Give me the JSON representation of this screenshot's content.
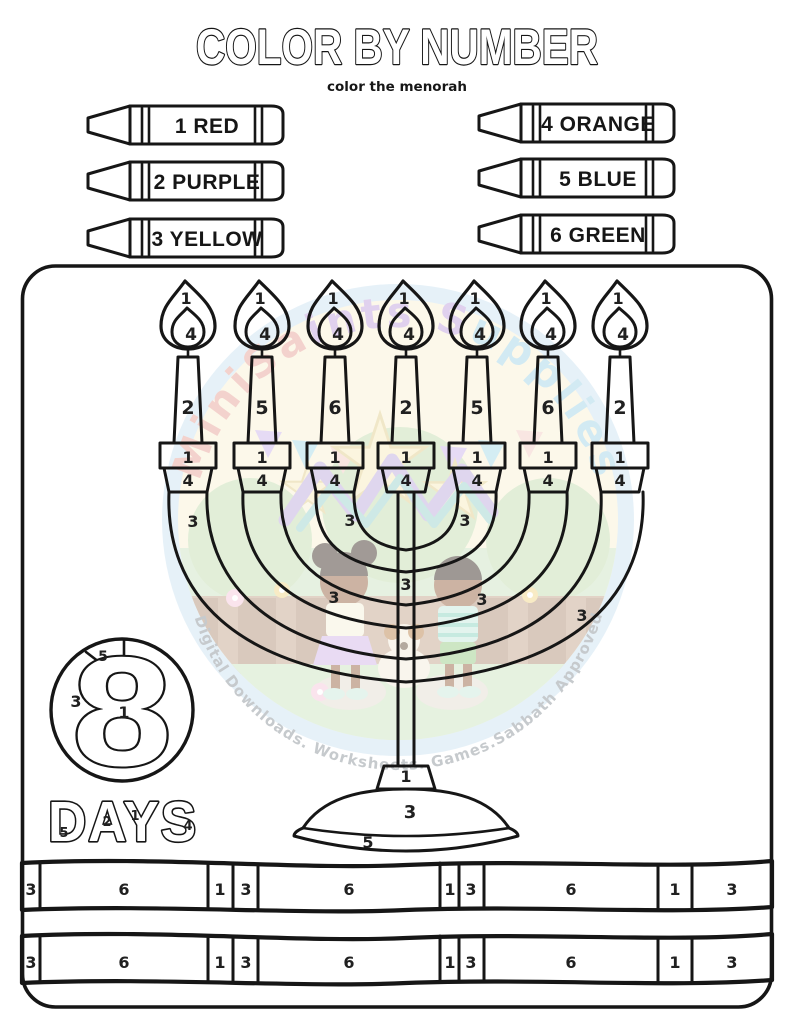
{
  "title": "COLOR BY NUMBER",
  "subtitle": "color the menorah",
  "crayons": [
    {
      "label": "1 RED"
    },
    {
      "label": "2 PURPLE"
    },
    {
      "label": "3 YELLOW"
    },
    {
      "label": "4 ORANGE"
    },
    {
      "label": "5 BLUE"
    },
    {
      "label": "6 GREEN"
    }
  ],
  "menorah": {
    "flame_outer": "1",
    "flame_inner": "4",
    "candles": [
      "2",
      "5",
      "6",
      "2",
      "5",
      "6",
      "2"
    ],
    "holder_top": "1",
    "holder_cup": "4",
    "arms": [
      "3",
      "3",
      "3",
      "3",
      "3",
      "3"
    ],
    "stem": "3",
    "base_neck": "1",
    "base_dome": "3",
    "base_rim": "5"
  },
  "eight_days": {
    "numeral": "8",
    "wedge": "5",
    "circle_left": "3",
    "center": "1",
    "word": "DAYS",
    "letter_numbers": [
      "5",
      "2",
      "1",
      "4"
    ]
  },
  "bands": {
    "row1": [
      "3",
      "6",
      "1",
      "3",
      "6",
      "1",
      "3",
      "6",
      "1",
      "3"
    ],
    "row2": [
      "3",
      "6",
      "1",
      "3",
      "6",
      "1",
      "3",
      "6",
      "1",
      "3"
    ]
  },
  "watermark": {
    "brand": "MiniSaints Supplies",
    "brand_parts": [
      "MiniSa",
      "ints S",
      "upplies"
    ],
    "tagline": "Digital Downloads. Worksheets. Games.Sabbath Approved",
    "palette": {
      "ring": "#cfe4f2",
      "cream": "#fbf3d6",
      "green": "#cfe5c4",
      "fence": "#b5947e",
      "pink": "#e9a79c",
      "purple": "#c3a4de",
      "blue": "#a7d7e8",
      "gray_text": "#8f969c"
    }
  }
}
